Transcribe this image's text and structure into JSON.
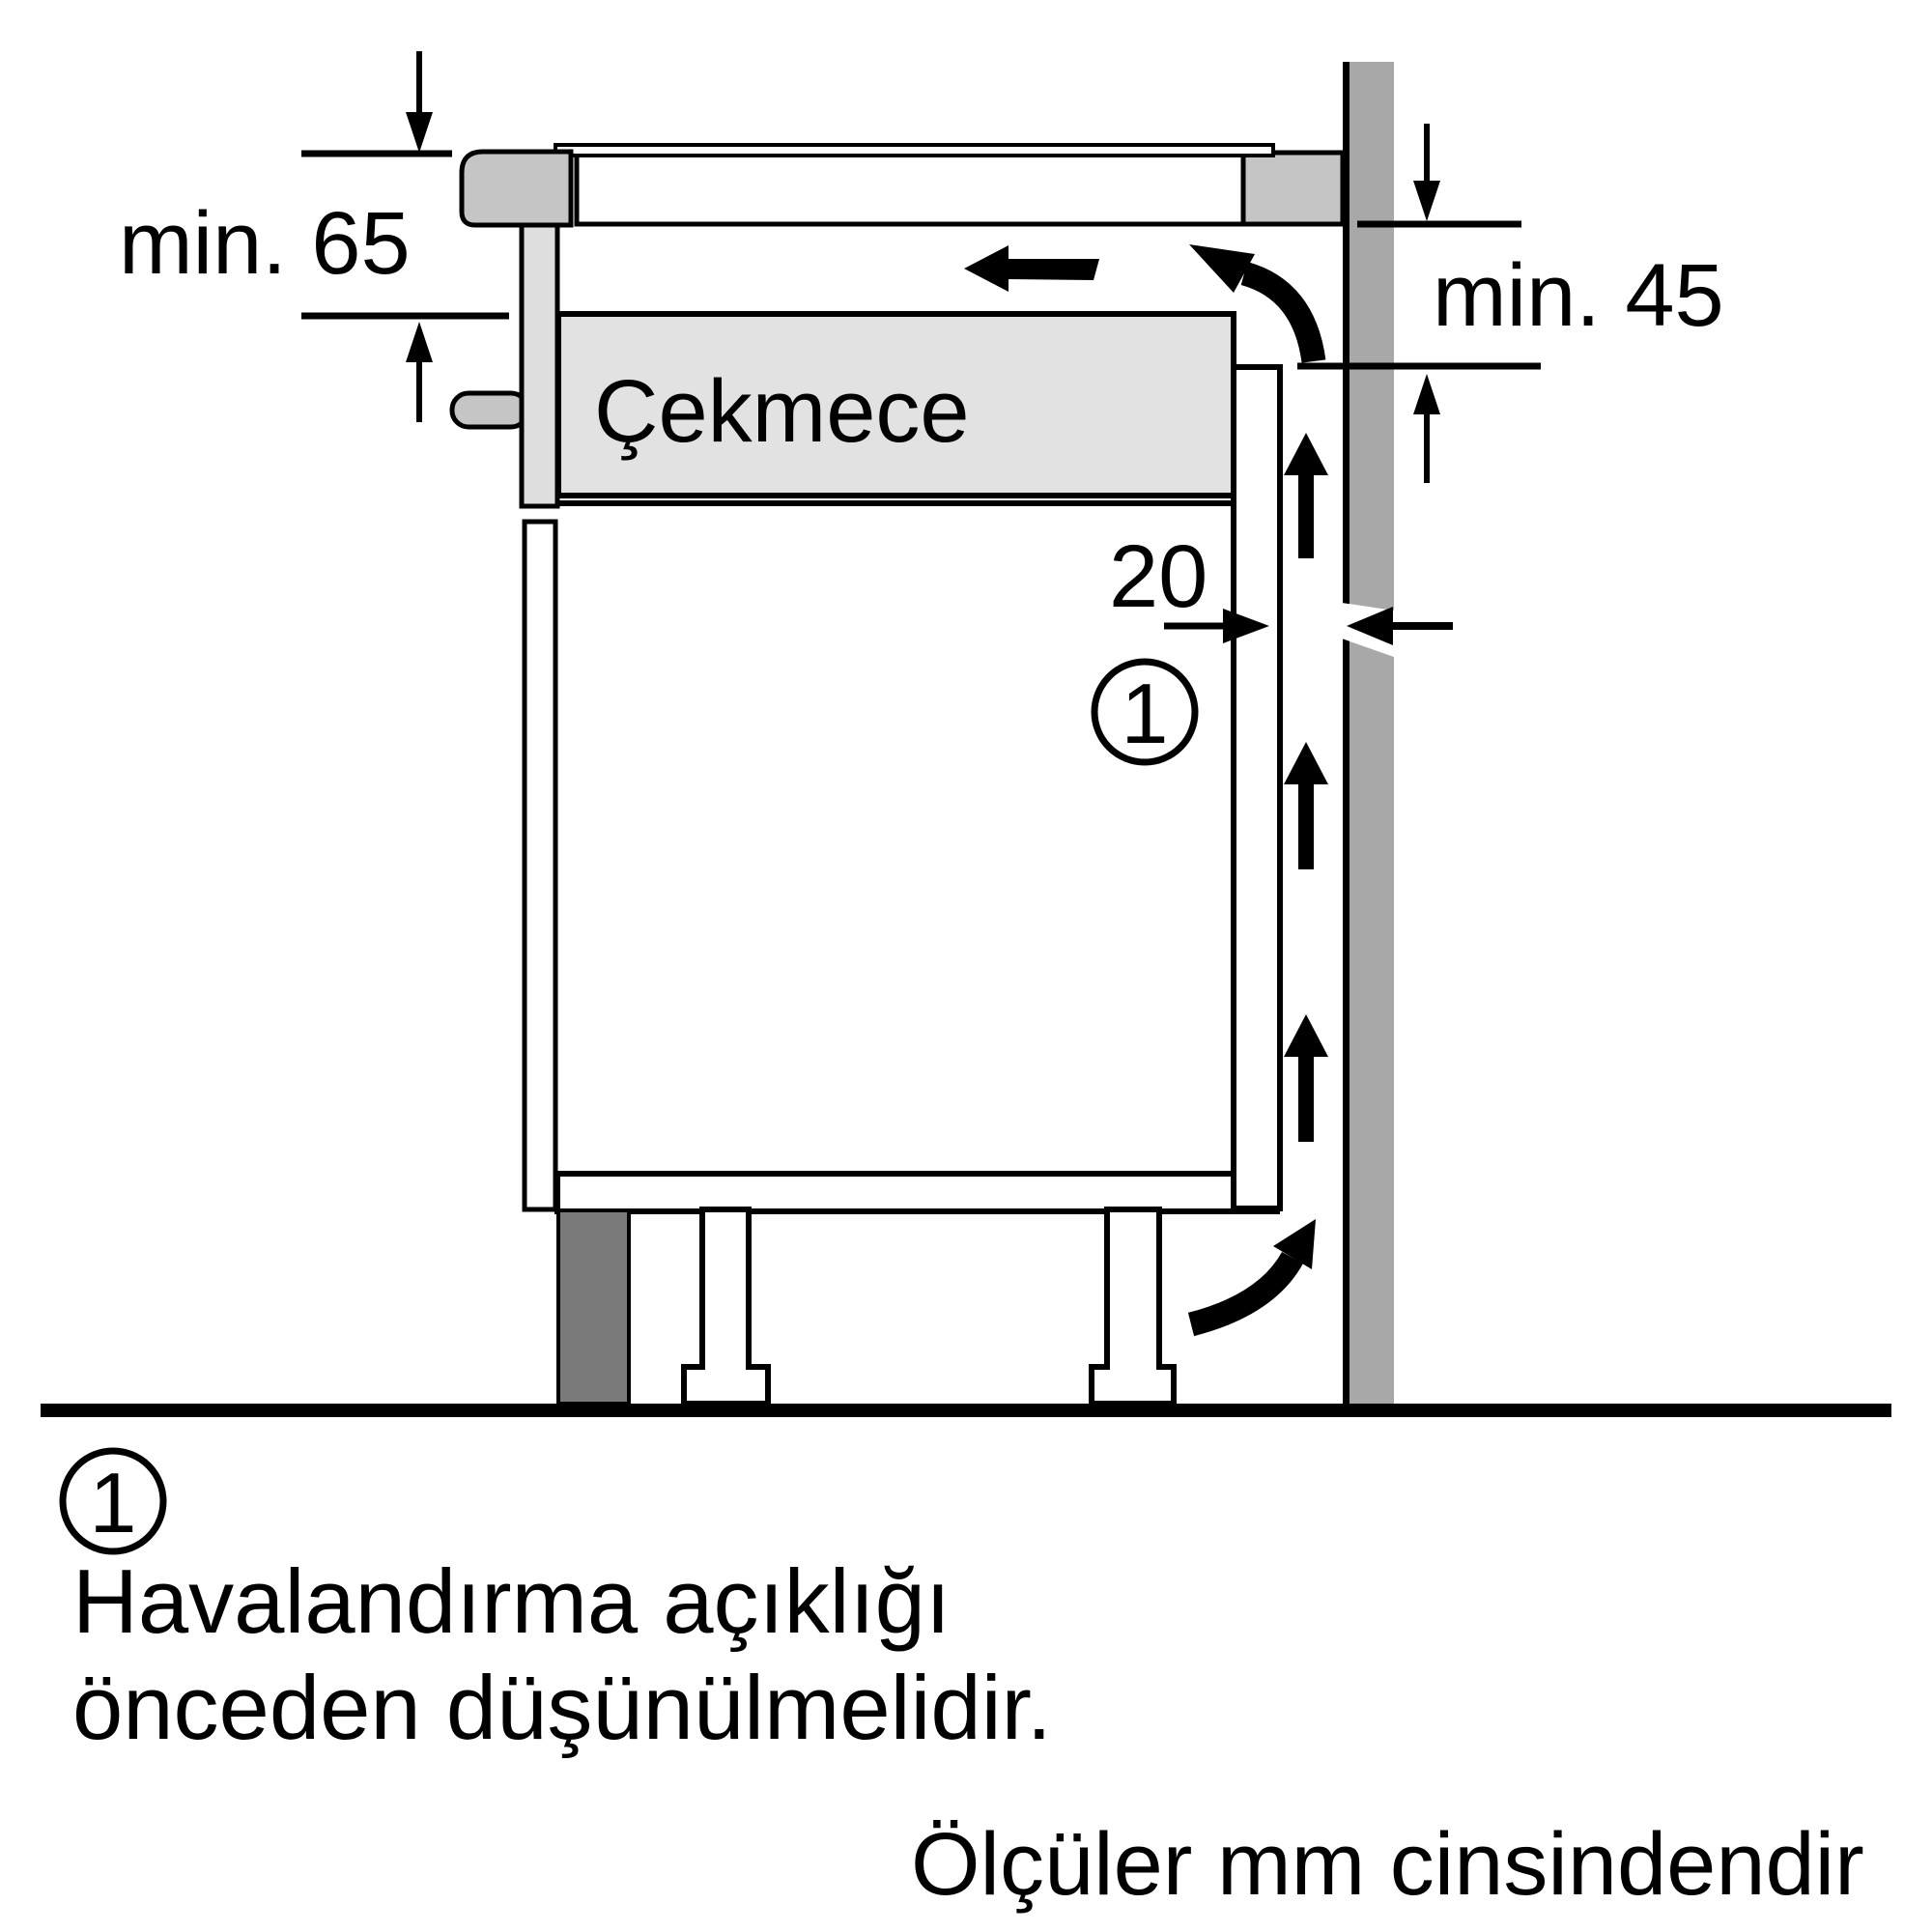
{
  "labels": {
    "drawer": "Çekmece",
    "dim_worktop_clearance": "min. 65",
    "dim_wall_clearance": "min. 45",
    "dim_vent_gap": "20",
    "callout_number": "1"
  },
  "legend": {
    "callout_number": "1",
    "note_line1": "Havalandırma açıklığı",
    "note_line2": "önceden düşünülmelidir.",
    "units_note": "Ölçüler mm cinsindendir"
  },
  "colors": {
    "wall": "#a8a8a8",
    "trim": "#c5c5c5",
    "panel": "#dedede",
    "drawer": "#e2e2e2",
    "plinth": "#7a7a7a",
    "line": "#000000",
    "background": "#ffffff"
  }
}
